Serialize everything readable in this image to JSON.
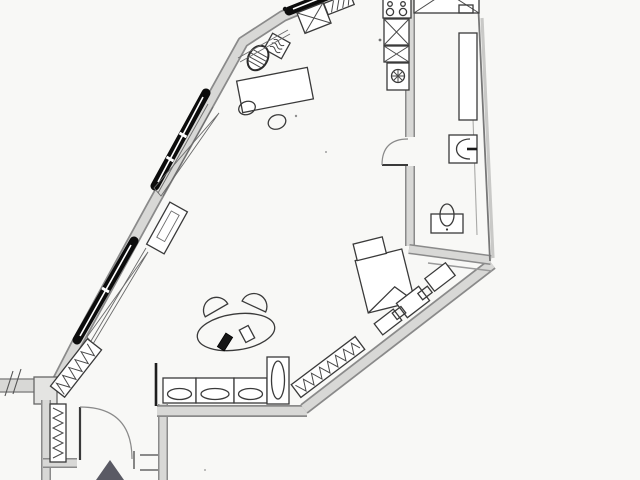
{
  "document": {
    "type": "architectural floor plan",
    "title": "Apartment floor plan sketch",
    "visible_text": "none",
    "style": "scanned line drawing on off-white paper"
  },
  "colors": {
    "background": "#f8f8f6",
    "wall_edge": "#8a8a8a",
    "wall_fill": "#d8d8d6",
    "window_black": "#0c0c0c",
    "line_dark": "#3a3a3a",
    "accent_arrow": "#5a5a64"
  },
  "rooms": [
    {
      "name": "living-dining-area",
      "contents": [
        "dining-table",
        "dining-chairs",
        "sofa",
        "floor-lamp",
        "kitchen-island-desk",
        "bar-stools"
      ]
    },
    {
      "name": "kitchen-strip",
      "contents": [
        "stove-4-burners",
        "cabinet-x-1",
        "cabinet-x-2",
        "extractor-fan-unit",
        "diagonal-cabinet-x",
        "washer-box",
        "kitchen-sink-oval"
      ]
    },
    {
      "name": "bathroom-strip",
      "contents": [
        "wardrobe-top",
        "tall-counter",
        "washbasin",
        "toilet"
      ]
    },
    {
      "name": "sleeping-alcove",
      "contents": [
        "bed-with-pillow",
        "bedside-table-1",
        "bedside-table-2",
        "bedside-table-3"
      ]
    },
    {
      "name": "entrance-hall",
      "contents": [
        "entrance-door-swing",
        "wall-radiator-vertical",
        "entry-direction-arrow"
      ]
    }
  ],
  "fixtures": {
    "windows": 3,
    "radiators": 4,
    "interior_doors": 2,
    "wall_break_symbol": "left edge",
    "entry_arrow_label": "entrance direction marker"
  },
  "furniture_counts": {
    "sofa_seats": 3,
    "dining_chairs": 2,
    "bar_stools": 2,
    "stove_burners": 4,
    "bedside_tables": 3
  }
}
